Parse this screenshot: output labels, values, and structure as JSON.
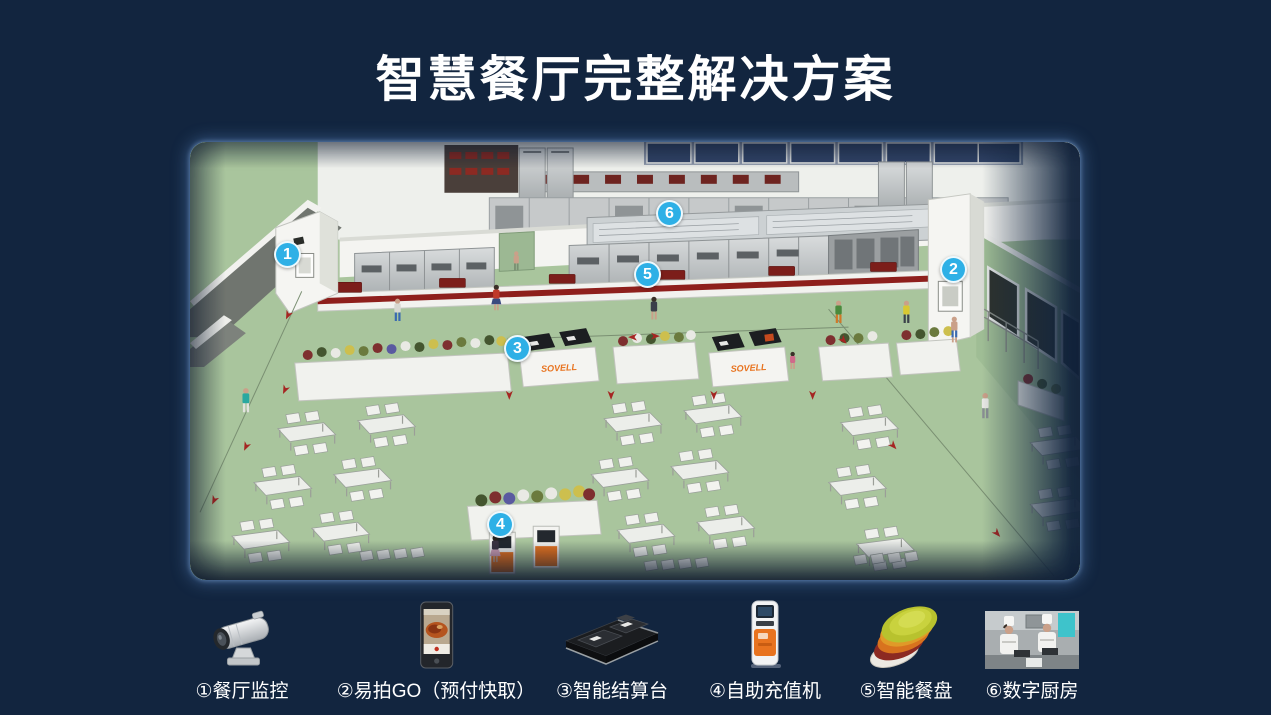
{
  "page": {
    "title": "智慧餐厅完整解决方案",
    "background_color": "#12253f",
    "accent_color": "#2eb0e6"
  },
  "scene": {
    "brand": "SOVELL",
    "floor_color": "#a9c59d",
    "marker_color": "#2eb0e6",
    "markers": [
      {
        "number": "1"
      },
      {
        "number": "2"
      },
      {
        "number": "3"
      },
      {
        "number": "4"
      },
      {
        "number": "5"
      },
      {
        "number": "6"
      }
    ]
  },
  "legend": {
    "items": [
      {
        "label": "①餐厅监控",
        "icon": "cctv-camera-icon"
      },
      {
        "label": "②易拍GO（预付快取）",
        "icon": "smartphone-icon"
      },
      {
        "label": "③智能结算台",
        "icon": "checkout-terminal-icon"
      },
      {
        "label": "④自助充值机",
        "icon": "recharge-kiosk-icon"
      },
      {
        "label": "⑤智能餐盘",
        "icon": "smart-plates-icon"
      },
      {
        "label": "⑥数字厨房",
        "icon": "digital-kitchen-icon"
      }
    ]
  }
}
